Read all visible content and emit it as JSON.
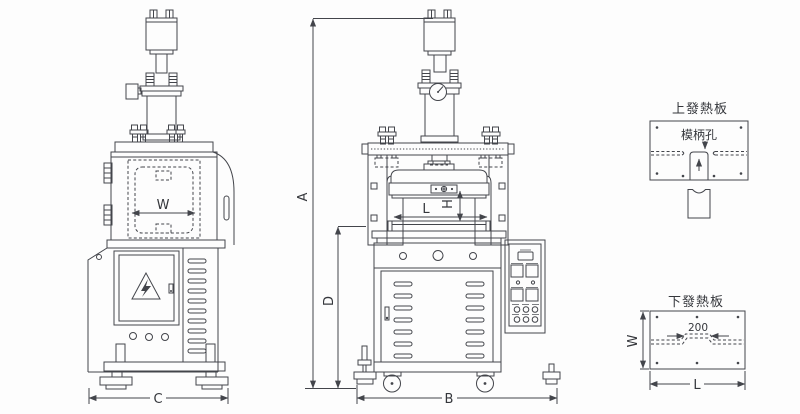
{
  "colors": {
    "line": "#43454b",
    "text": "#35373c",
    "bg": "#fdfdfd"
  },
  "views": {
    "front": {
      "dims": {
        "w": "W",
        "c": "C"
      }
    },
    "side": {
      "dims": {
        "a": "A",
        "b": "B",
        "d": "D",
        "l": "L",
        "h": "H"
      }
    }
  },
  "plates": {
    "upper": {
      "title": "上發熱板",
      "hole_label": "模柄孔"
    },
    "lower": {
      "title": "下發熱板",
      "width_label": "200",
      "dims": {
        "w": "W",
        "l": "L"
      }
    }
  }
}
